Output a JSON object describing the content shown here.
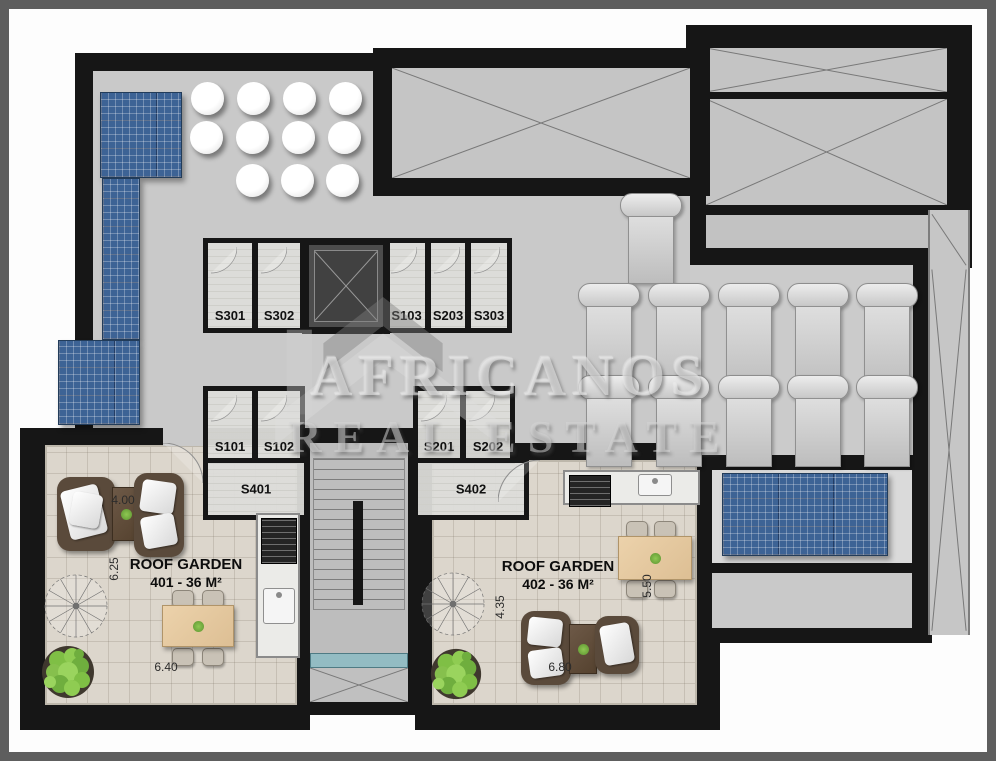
{
  "plan": {
    "watermark": {
      "brand": "AFRICANOS",
      "tagline": "REAL ESTATE"
    },
    "rooms": {
      "s301": "S301",
      "s302": "S302",
      "s103": "S103",
      "s203": "S203",
      "s303": "S303",
      "s101": "S101",
      "s102": "S102",
      "s401": "S401",
      "s201": "S201",
      "s202": "S202",
      "s402": "S402"
    },
    "gardens": {
      "g401": {
        "title": "ROOF GARDEN",
        "area": "401 - 36 M²",
        "dim_width": "4.00",
        "dim_left": "6.25",
        "dim_bottom": "6.40"
      },
      "g402": {
        "title": "ROOF GARDEN",
        "area": "402 - 36 M²",
        "dim_left": "4.35",
        "dim_right": "5.50",
        "dim_bottom": "6.80"
      }
    },
    "colors": {
      "wall": "#161616",
      "roof_floor": "#c9c9c9",
      "garden_floor": "#dcd6cc",
      "solar_panel": "#3d6395",
      "canopy": "#93bcc3",
      "plant": "#7fbf45",
      "frame": "#5e5e5e"
    }
  }
}
